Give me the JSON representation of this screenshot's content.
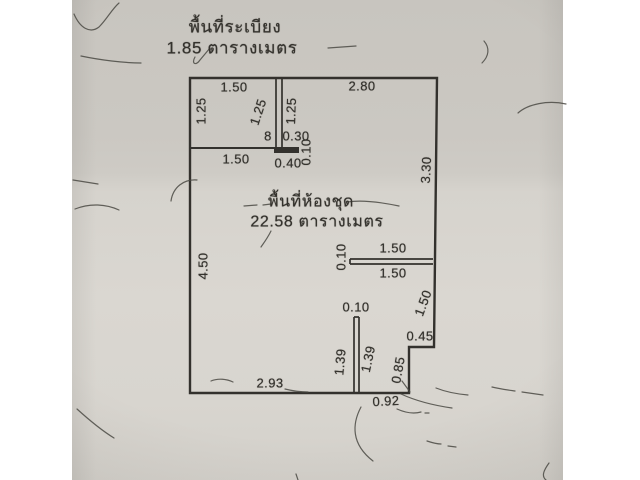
{
  "colors": {
    "paper": "#d2cfc9",
    "paper_dark": "#c8c5bf",
    "paper_light": "#dad7d1",
    "margin": "#ffffff",
    "line": "#33312d",
    "text": "#34322d"
  },
  "floorplan": {
    "annotations": {
      "balcony": {
        "title": "พื้นที่ระเบียง",
        "value": "1.85 ตารางเมตร"
      },
      "unit": {
        "title": "พื้นที่ห้องชุด",
        "value": "22.58 ตารางเมตร"
      }
    },
    "dimension_labels": [
      {
        "text": "1.50",
        "x": 234,
        "y": 87,
        "rot": 0
      },
      {
        "text": "2.80",
        "x": 362,
        "y": 86,
        "rot": 0
      },
      {
        "text": "1.25",
        "x": 201,
        "y": 111,
        "rot": -90
      },
      {
        "text": "1.25",
        "x": 258,
        "y": 112,
        "rot": -72
      },
      {
        "text": "1.25",
        "x": 291,
        "y": 111,
        "rot": -88
      },
      {
        "text": "8",
        "x": 268,
        "y": 136,
        "rot": 0
      },
      {
        "text": "0.30",
        "x": 296,
        "y": 136,
        "rot": 0
      },
      {
        "text": "0.10",
        "x": 306,
        "y": 152,
        "rot": -90
      },
      {
        "text": "1.50",
        "x": 236,
        "y": 159,
        "rot": 0
      },
      {
        "text": "0.40",
        "x": 288,
        "y": 163,
        "rot": 0
      },
      {
        "text": "3.30",
        "x": 426,
        "y": 170,
        "rot": -87
      },
      {
        "text": "4.50",
        "x": 203,
        "y": 266,
        "rot": -90
      },
      {
        "text": "0.10",
        "x": 341,
        "y": 257,
        "rot": -90
      },
      {
        "text": "1.50",
        "x": 393,
        "y": 248,
        "rot": 0
      },
      {
        "text": "1.50",
        "x": 393,
        "y": 273,
        "rot": 0
      },
      {
        "text": "1.50",
        "x": 423,
        "y": 303,
        "rot": -70
      },
      {
        "text": "0.10",
        "x": 356,
        "y": 307,
        "rot": 0
      },
      {
        "text": "0.45",
        "x": 420,
        "y": 336,
        "rot": 0
      },
      {
        "text": "1.39",
        "x": 340,
        "y": 362,
        "rot": -85
      },
      {
        "text": "1.39",
        "x": 368,
        "y": 359,
        "rot": -78
      },
      {
        "text": "0.85",
        "x": 398,
        "y": 370,
        "rot": -80
      },
      {
        "text": "2.93",
        "x": 270,
        "y": 383,
        "rot": 0
      },
      {
        "text": "0.92",
        "x": 386,
        "y": 401,
        "rot": -3
      }
    ]
  }
}
